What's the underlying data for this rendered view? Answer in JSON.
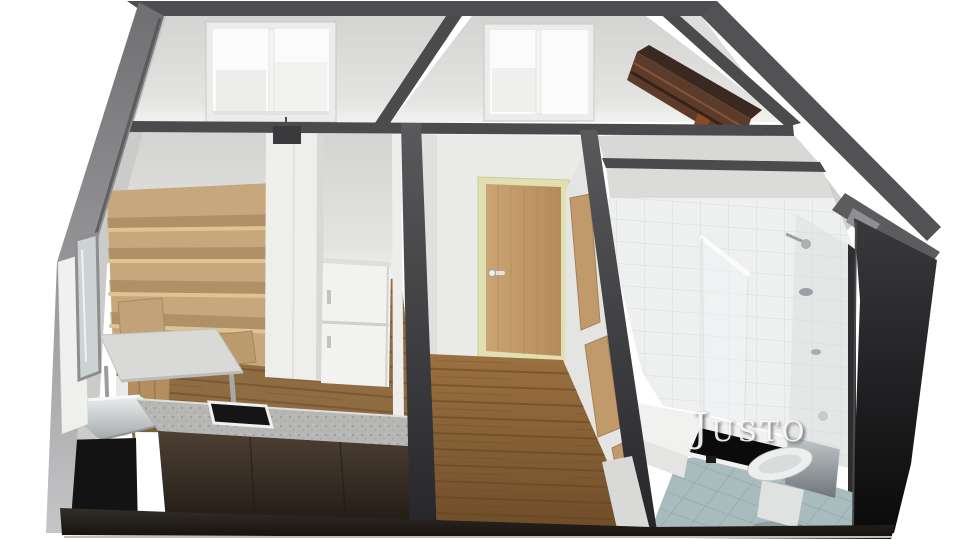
{
  "watermark": {
    "text": "Justo"
  },
  "palette": {
    "wall_cut": "#4b4b4e",
    "room_wall": "#d8d8d6",
    "wood_floor": "#8a6337",
    "light_wood": "#c6a87c",
    "walnut": "#5d3b2a",
    "door_wood": "#c09a6a",
    "door_frame": "#e0e0b2",
    "granite": "#b6b6b4",
    "cabinet_dark": "#3c332a",
    "bath_tile": "#eef0ef",
    "bath_floor": "#a8bcbd",
    "black_wall": "#131313",
    "watermark": "#f7f7f7"
  },
  "scene": {
    "type": "3d-floor-plan-render",
    "view": "isometric-cutaway-top",
    "rooms": [
      {
        "name": "bedroom-back-left",
        "features": [
          "sliding-window"
        ]
      },
      {
        "name": "bedroom-back-middle",
        "features": [
          "sliding-window"
        ]
      },
      {
        "name": "storage-back-right",
        "features": [
          "walnut-bookshelf"
        ]
      },
      {
        "name": "living-kitchen-left",
        "features": [
          "wood-bookshelf",
          "desk",
          "chair",
          "white-wardrobe",
          "refrigerator",
          "kitchen-counter",
          "cooktop",
          "sink-unit"
        ]
      },
      {
        "name": "hallway-center",
        "features": [
          "entry-door",
          "wood-plank-floor",
          "closet-wood-panels"
        ]
      },
      {
        "name": "bathroom-right",
        "features": [
          "white-wall-tiles",
          "glass-shower-partition",
          "shower-fixtures",
          "bathtub",
          "toilet",
          "blue-tile-floor"
        ]
      }
    ]
  }
}
